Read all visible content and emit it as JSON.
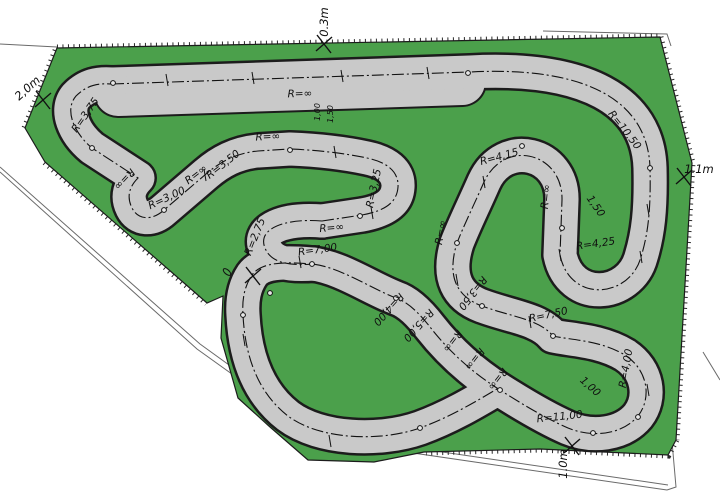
{
  "colors": {
    "background": "#ffffff",
    "grass": "#4ba04b",
    "track": "#c9c9c9",
    "outline": "#1c1c1c",
    "boundary": "#6a6a6a"
  },
  "radius_labels": [
    {
      "text": "R=∞",
      "x": 300,
      "y": 97,
      "rot": -2
    },
    {
      "text": "R=10,50",
      "x": 622,
      "y": 132,
      "rot": 52
    },
    {
      "text": "R=4,15",
      "x": 500,
      "y": 160,
      "rot": -15
    },
    {
      "text": "R=∞",
      "x": 549,
      "y": 197,
      "rot": -84
    },
    {
      "text": "R=4,25",
      "x": 596,
      "y": 247,
      "rot": -8
    },
    {
      "text": "R=∞",
      "x": 268,
      "y": 140,
      "rot": -3
    },
    {
      "text": "R=3,75",
      "x": 88,
      "y": 117,
      "rot": -55
    },
    {
      "text": "R=∞",
      "x": 122,
      "y": 177,
      "rot": 133
    },
    {
      "text": "R=3,00",
      "x": 168,
      "y": 201,
      "rot": -25
    },
    {
      "text": "R=∞",
      "x": 198,
      "y": 177,
      "rot": -38
    },
    {
      "text": "R=3,50",
      "x": 225,
      "y": 167,
      "rot": -38
    },
    {
      "text": "R=3,25",
      "x": 377,
      "y": 189,
      "rot": -78
    },
    {
      "text": "R=∞",
      "x": 332,
      "y": 231,
      "rot": -5
    },
    {
      "text": "R=2,75",
      "x": 258,
      "y": 238,
      "rot": -68
    },
    {
      "text": "R=7,00",
      "x": 318,
      "y": 253,
      "rot": -8
    },
    {
      "text": "R=4,00",
      "x": 386,
      "y": 307,
      "rot": 132
    },
    {
      "text": "R=5,00",
      "x": 416,
      "y": 323,
      "rot": 132
    },
    {
      "text": "R=3,50",
      "x": 470,
      "y": 291,
      "rot": 128
    },
    {
      "text": "R=∞",
      "x": 450,
      "y": 339,
      "rot": 128
    },
    {
      "text": "R=∞",
      "x": 472,
      "y": 357,
      "rot": 128
    },
    {
      "text": "R=∞",
      "x": 495,
      "y": 377,
      "rot": 128
    },
    {
      "text": "R=7,50",
      "x": 549,
      "y": 318,
      "rot": -12
    },
    {
      "text": "R=4,00",
      "x": 629,
      "y": 369,
      "rot": -80
    },
    {
      "text": "R=11,00",
      "x": 560,
      "y": 420,
      "rot": -6
    },
    {
      "text": "R=∞",
      "x": 444,
      "y": 233,
      "rot": -80
    }
  ],
  "island_radius_labels": [
    {
      "text": "1,50",
      "x": 593,
      "y": 208,
      "rot": 55
    },
    {
      "text": "1,00",
      "x": 588,
      "y": 389,
      "rot": 42
    }
  ],
  "strip_width_labels": [
    {
      "text": "1,00",
      "x": 320,
      "y": 112,
      "rot": -90
    },
    {
      "text": "1,50",
      "x": 333,
      "y": 114,
      "rot": -90
    }
  ],
  "edge_dimensions": [
    {
      "text": "2,0m",
      "x": 30,
      "y": 91,
      "rot": -42
    },
    {
      "text": "0.3m",
      "x": 328,
      "y": 22,
      "rot": -90
    },
    {
      "text": "1.1m",
      "x": 699,
      "y": 173,
      "rot": 0
    },
    {
      "text": "1.0m",
      "x": 567,
      "y": 464,
      "rot": -90
    }
  ],
  "markers": {
    "circles": [
      [
        113,
        83
      ],
      [
        468,
        73
      ],
      [
        650,
        168
      ],
      [
        562,
        228
      ],
      [
        522,
        146
      ],
      [
        457,
        243
      ],
      [
        482,
        306
      ],
      [
        553,
        336
      ],
      [
        638,
        417
      ],
      [
        500,
        390
      ],
      [
        396,
        298
      ],
      [
        312,
        264
      ],
      [
        243,
        315
      ],
      [
        420,
        428
      ],
      [
        360,
        216
      ],
      [
        290,
        150
      ],
      [
        164,
        210
      ],
      [
        92,
        148
      ],
      [
        270,
        293
      ],
      [
        593,
        433
      ]
    ],
    "plus_ticks": [
      [
        167,
        80
      ],
      [
        253,
        78
      ],
      [
        342,
        76
      ],
      [
        428,
        73
      ],
      [
        641,
        257
      ],
      [
        560,
        255
      ],
      [
        205,
        175
      ],
      [
        335,
        152
      ],
      [
        457,
        280
      ],
      [
        530,
        322
      ],
      [
        648,
        390
      ],
      [
        330,
        441
      ],
      [
        300,
        262
      ],
      [
        244,
        340
      ],
      [
        372,
        213
      ],
      [
        648,
        210
      ],
      [
        484,
        182
      ]
    ],
    "x_marks": [
      [
        253,
        276
      ],
      [
        43,
        100
      ],
      [
        324,
        44
      ],
      [
        684,
        177
      ],
      [
        572,
        446
      ]
    ]
  }
}
